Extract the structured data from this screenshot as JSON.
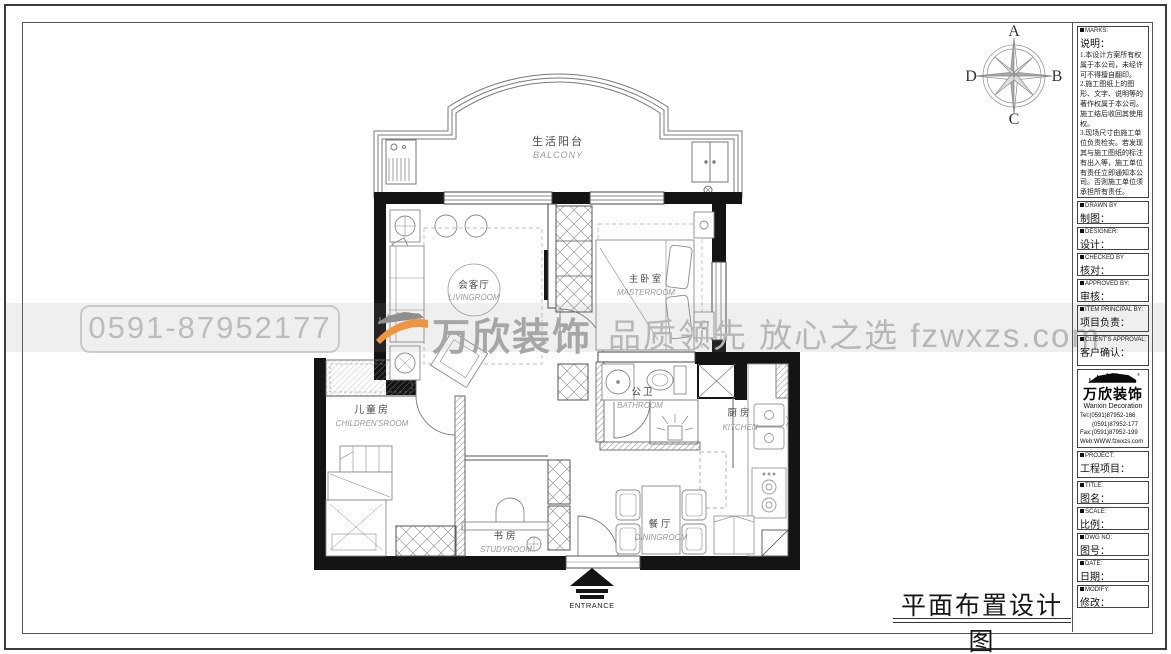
{
  "sheet": {
    "title": "平面布置设计图"
  },
  "compass": {
    "n": "A",
    "e": "B",
    "s": "C",
    "w": "D"
  },
  "watermark": {
    "phone": "0591-87952177",
    "brand": "万欣装饰",
    "slogan": "品质领先 放心之选  fzwxzs.com",
    "accent_color": "#ef9540",
    "text_color": "#b7b7b7"
  },
  "floorplan": {
    "wall_color": "#141414",
    "rooms": [
      {
        "id": "balcony",
        "cn": "生活阳台",
        "en": "BALCONY"
      },
      {
        "id": "living",
        "cn": "会客厅",
        "en": "LIVINGROOM"
      },
      {
        "id": "master",
        "cn": "主卧室",
        "en": "MASTERROOM"
      },
      {
        "id": "bathroom",
        "cn": "公卫",
        "en": "BATHROOM"
      },
      {
        "id": "kitchen",
        "cn": "厨房",
        "en": "KITCHEN"
      },
      {
        "id": "children",
        "cn": "儿童房",
        "en": "CHILDREN'SROOM"
      },
      {
        "id": "study",
        "cn": "书房",
        "en": "STUDYROOM"
      },
      {
        "id": "dining",
        "cn": "餐厅",
        "en": "DININGROOM"
      }
    ],
    "entrance_label": "ENTRANCE"
  },
  "titleblock": {
    "marks": {
      "label_en": "MARKS:",
      "label_cn": "说明：",
      "notes": [
        "1.本设计方案所有权属于本公司，未经许可不得擅自翻印。",
        "2.施工图纸上的图形、文字、说明等的著作权属于本公司。施工结后收回其使用权。",
        "3.现场尺寸由施工单位负责检实。若发现其与施工图纸的标注有出入等，施工单位有责任立即通知本公司。否则施工单位须承担所有责任。",
        "4.本设计方案是依客户要求设计。经客户签字即视为同意认可，不得随意更改。"
      ]
    },
    "fields": [
      {
        "en": "DRAWN BY",
        "cn": "制图："
      },
      {
        "en": "DESIGNER:",
        "cn": "设计："
      },
      {
        "en": "CHECKED BY",
        "cn": "核对："
      },
      {
        "en": "APPROVED BY:",
        "cn": "审核："
      },
      {
        "en": "ITEM PRINCIPAL BY:",
        "cn": "项目负责："
      },
      {
        "en": "CLIENT'S APPROVAL:",
        "cn": "客户确认："
      }
    ],
    "company": {
      "name_cn": "万欣装饰",
      "name_en": "Wanxin Decoration",
      "tel1": "Tel:(0591)87952-166",
      "tel2": "(0591)87952-177",
      "fax": "Fax:(0591)87952-199",
      "web": "Web:WWW.fzwxzs.com"
    },
    "fields2": [
      {
        "en": "PROJECT:",
        "cn": "工程项目："
      },
      {
        "en": "TITLE:",
        "cn": "图名："
      },
      {
        "en": "SCALE:",
        "cn": "比例："
      },
      {
        "en": "DWG NO:",
        "cn": "图号："
      },
      {
        "en": "DATE:",
        "cn": "日期："
      },
      {
        "en": "MODIFY:",
        "cn": "修改："
      }
    ]
  }
}
